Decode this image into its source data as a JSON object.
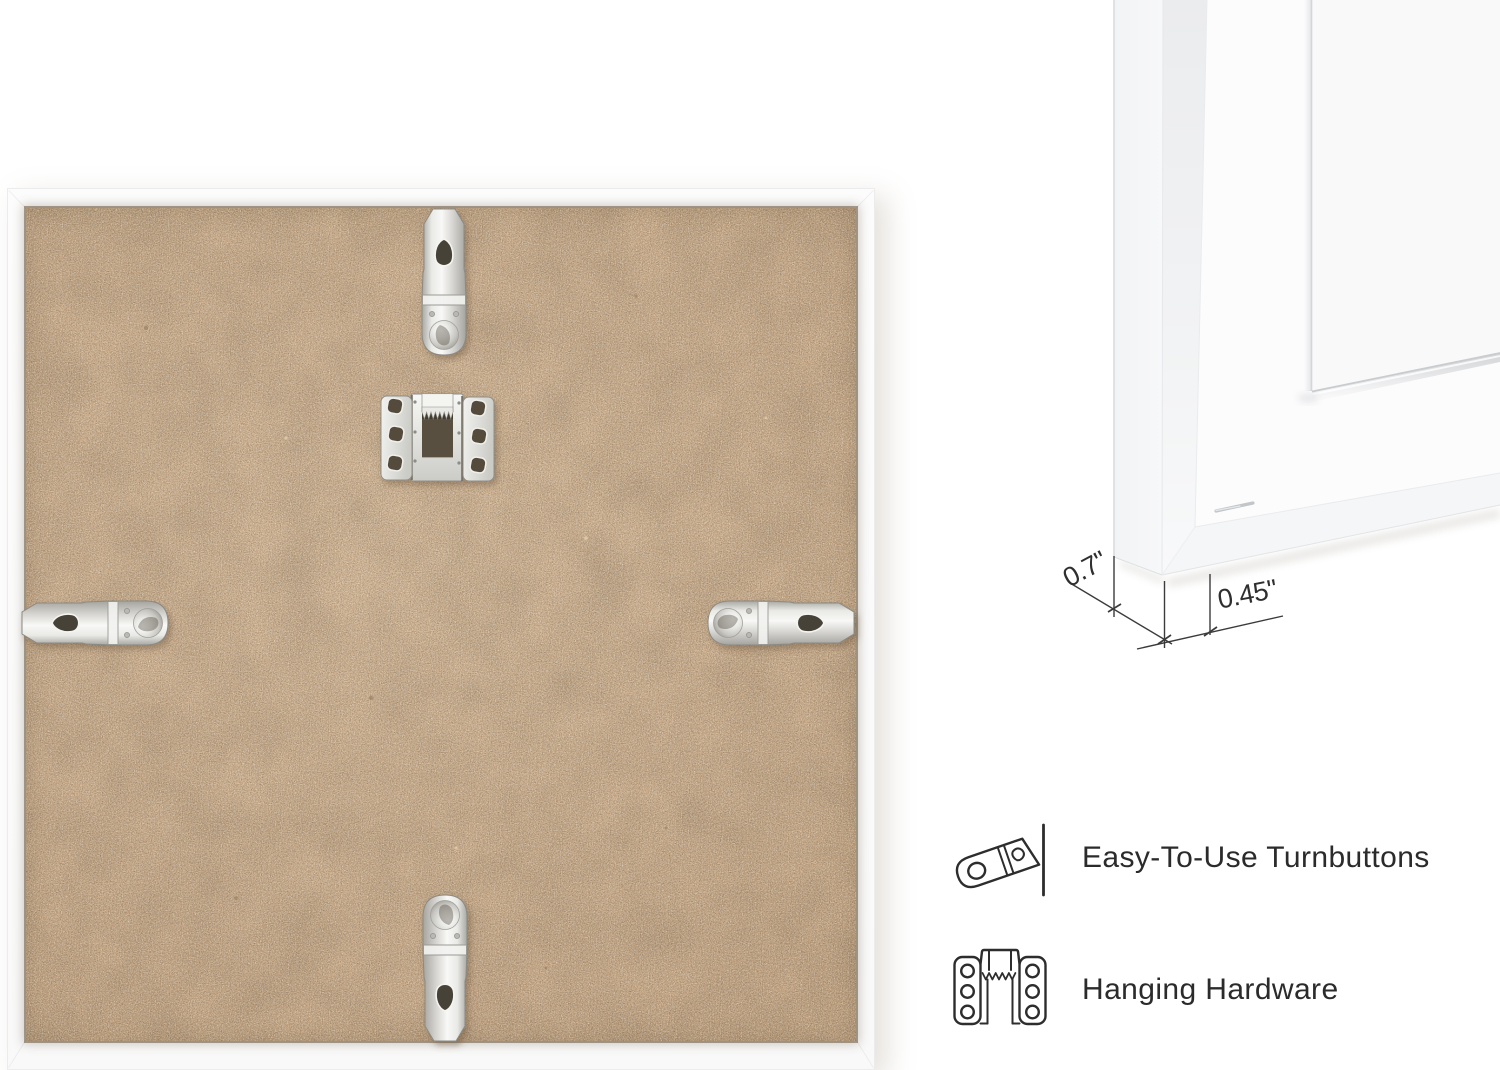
{
  "canvas": {
    "background": "#ffffff"
  },
  "dimension_callout": {
    "depth_label": "0.7\"",
    "face_label": "0.45\""
  },
  "features": [
    {
      "icon": "turnbutton-icon",
      "label": "Easy-To-Use Turnbuttons"
    },
    {
      "icon": "hanging-hardware-icon",
      "label": "Hanging Hardware"
    }
  ],
  "colors": {
    "mdf_board": "#cfb08d",
    "mdf_groove": "#604d34",
    "frame_white": "#fbfbfb",
    "hardware_metal": "#d8d8d4",
    "annotation_ink": "#2d2d2d",
    "label_text": "#2b2b2b"
  }
}
